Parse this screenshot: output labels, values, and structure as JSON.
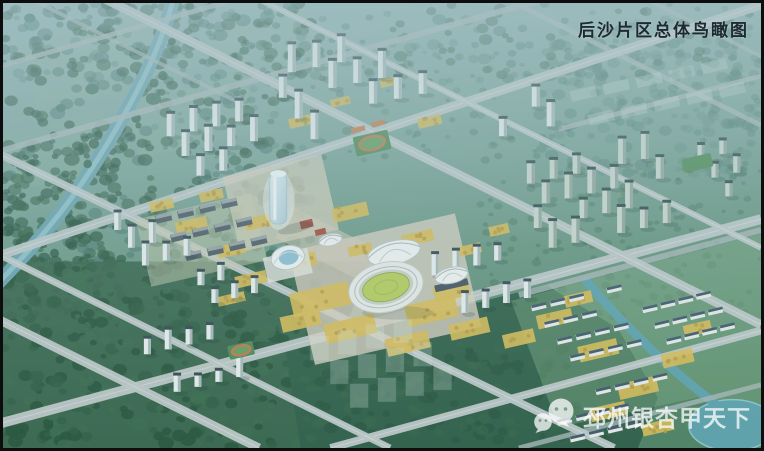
{
  "title": {
    "text": "后沙片区总体鸟瞰图"
  },
  "watermark": {
    "icon": "wechat-icon",
    "text": "邳州银杏甲天下"
  },
  "scene": {
    "colors": {
      "sky_haze": "#a9c4ca",
      "base_top": "#93b5b7",
      "base_mid": "#78a396",
      "base_bottom": "#4e8263",
      "forest_dark": "#24523a",
      "forest_mid": "#35634a",
      "forest_teal": "#4a7a70",
      "forest_light": "#5d8a7e",
      "field_patch": "#8cb49a",
      "road": "#a9b8b8",
      "road_major": "#bfc9c9",
      "road_line": "#e8eded",
      "river": "#69a4b0",
      "river_highlight": "#9ac9d1",
      "canal": "#5da2ad",
      "tower_body": "#e9efee",
      "tower_shade": "#a7b8ba",
      "tower_roof": "#33474f",
      "tower_green_body": "#ccd9cf",
      "tower_green_shade": "#93a89c",
      "tower_green_roof": "#2e4a4a",
      "ginkgo": "#d9bc55",
      "ginkgo_dark": "#b89b3e",
      "pavement": "#d8cfc0",
      "pavement_civic": "#d5cfba",
      "stadium_ring": "#e9ecea",
      "stadium_track": "#c5d2c9",
      "stadium_field": "#b7cd5f",
      "pitch_green": "#4e8b55",
      "pitch_track": "#c0784e",
      "shell_white": "#f0f4f3",
      "dome_blue": "#8fc0d4",
      "villa_wall": "#e9ece9",
      "villa_roof": "#3e586b",
      "slab_dark": "#4e5c66",
      "slab_top": "#97a2a6",
      "roof_red": "#a84b3c",
      "roof_orange": "#c77f4f",
      "ghost_building": "#d8e8e0",
      "title_color": "#1e2a33",
      "watermark_white": "#ffffff",
      "border": "#0d0d0d"
    }
  }
}
